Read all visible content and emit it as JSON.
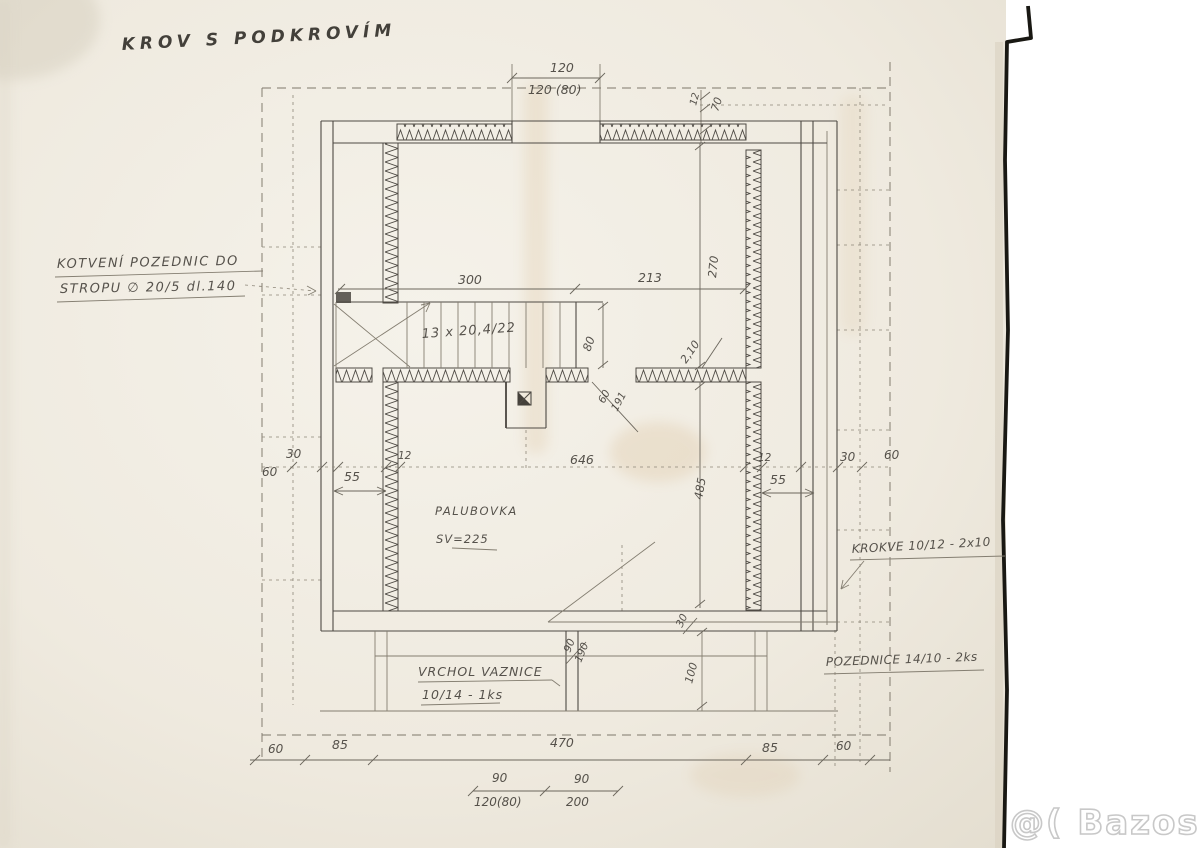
{
  "watermark": {
    "text": "@( Bazos.cz"
  },
  "colors": {
    "paper": "#f0ebe0",
    "pencil": "#4e4a44",
    "watermark_stroke": "#c8c8c8"
  },
  "labels": [
    {
      "name": "drawing-title",
      "text": "KROV S PODKROVÍM",
      "x": 122,
      "y": 50,
      "size": 17,
      "ls": 5,
      "rot": -3,
      "cls": "title"
    },
    {
      "name": "note-anchoring-line1",
      "text": "KOTVENÍ POZEDNIC DO",
      "x": 57,
      "y": 268,
      "size": 13,
      "ls": 1.5,
      "rot": -1
    },
    {
      "name": "note-anchoring-line2",
      "text": "STROPU ∅ 20/5 dl.140",
      "x": 60,
      "y": 293,
      "size": 13,
      "ls": 1.5,
      "rot": -1
    },
    {
      "name": "dim-top-120",
      "text": "120",
      "x": 550,
      "y": 72,
      "size": 12.5
    },
    {
      "name": "dim-top-120-80",
      "text": "120 (80)",
      "x": 528,
      "y": 94,
      "size": 12.5
    },
    {
      "name": "dim-top-12",
      "text": "12",
      "x": 696,
      "y": 106,
      "size": 10,
      "rot": -75
    },
    {
      "name": "dim-top-70",
      "text": "70",
      "x": 718,
      "y": 112,
      "size": 11,
      "rot": -72
    },
    {
      "name": "dim-300",
      "text": "300",
      "x": 458,
      "y": 284,
      "size": 12.5
    },
    {
      "name": "dim-213",
      "text": "213",
      "x": 638,
      "y": 282,
      "size": 12.5
    },
    {
      "name": "dim-270",
      "text": "270",
      "x": 716,
      "y": 278,
      "size": 11.5,
      "rot": -84
    },
    {
      "name": "stairs-label",
      "text": "13 x 20,4/22",
      "x": 422,
      "y": 338,
      "size": 13,
      "ls": 1,
      "rot": -4
    },
    {
      "name": "dim-80",
      "text": "80",
      "x": 590,
      "y": 352,
      "size": 11.5,
      "rot": -70
    },
    {
      "name": "dim-2-10",
      "text": "2,10",
      "x": 686,
      "y": 364,
      "size": 11,
      "rot": -55
    },
    {
      "name": "dim-60-diag",
      "text": "60",
      "x": 604,
      "y": 404,
      "size": 10.5,
      "rot": -62
    },
    {
      "name": "dim-191-diag",
      "text": "191",
      "x": 617,
      "y": 412,
      "size": 10.5,
      "rot": -62
    },
    {
      "name": "dim-left-30",
      "text": "30",
      "x": 286,
      "y": 458,
      "size": 12
    },
    {
      "name": "dim-left-60",
      "text": "60",
      "x": 262,
      "y": 476,
      "size": 12
    },
    {
      "name": "dim-left-55",
      "text": "55",
      "x": 344,
      "y": 481,
      "size": 12.5
    },
    {
      "name": "dim-left-12",
      "text": "12",
      "x": 398,
      "y": 459,
      "size": 10.5
    },
    {
      "name": "dim-646",
      "text": "646",
      "x": 570,
      "y": 464,
      "size": 12.5
    },
    {
      "name": "dim-right-12",
      "text": "12",
      "x": 758,
      "y": 461,
      "size": 10.5
    },
    {
      "name": "dim-right-55",
      "text": "55",
      "x": 770,
      "y": 484,
      "size": 12.5
    },
    {
      "name": "dim-right-30",
      "text": "30",
      "x": 840,
      "y": 461,
      "size": 12
    },
    {
      "name": "dim-right-60",
      "text": "60",
      "x": 884,
      "y": 459,
      "size": 12
    },
    {
      "name": "dim-485",
      "text": "485",
      "x": 702,
      "y": 500,
      "size": 11.5,
      "rot": -80
    },
    {
      "name": "note-palubovka",
      "text": "PALUBOVKA",
      "x": 435,
      "y": 515,
      "size": 11.5,
      "ls": 1.5
    },
    {
      "name": "note-palubovka-sv",
      "text": "SV=225",
      "x": 436,
      "y": 543,
      "size": 11.5,
      "ls": 1
    },
    {
      "name": "note-krokve",
      "text": "KROKVE 10/12 - 2x10",
      "x": 852,
      "y": 553,
      "size": 12,
      "rot": -3,
      "ls": 0.5
    },
    {
      "name": "dim-30-bottom",
      "text": "30",
      "x": 682,
      "y": 628,
      "size": 10.5,
      "rot": -65
    },
    {
      "name": "dim-90-frac",
      "text": "90",
      "x": 570,
      "y": 653,
      "size": 10.5,
      "rot": -68
    },
    {
      "name": "dim-190-frac",
      "text": "190",
      "x": 581,
      "y": 663,
      "size": 10.5,
      "rot": -68
    },
    {
      "name": "dim-100",
      "text": "100",
      "x": 692,
      "y": 684,
      "size": 11,
      "rot": -75
    },
    {
      "name": "note-vaznice-line1",
      "text": "VRCHOL VAZNICE",
      "x": 418,
      "y": 676,
      "size": 12.5,
      "ls": 1
    },
    {
      "name": "note-vaznice-line2",
      "text": "10/14 - 1ks",
      "x": 422,
      "y": 699,
      "size": 12.5,
      "ls": 1
    },
    {
      "name": "note-pozednice",
      "text": "POZEDNICE 14/10 - 2ks",
      "x": 826,
      "y": 666,
      "size": 12,
      "rot": -2,
      "ls": 0.5
    },
    {
      "name": "dim-bottom-60-left",
      "text": "60",
      "x": 268,
      "y": 753,
      "size": 12
    },
    {
      "name": "dim-bottom-85-left",
      "text": "85",
      "x": 332,
      "y": 749,
      "size": 12.5
    },
    {
      "name": "dim-bottom-470",
      "text": "470",
      "x": 550,
      "y": 747,
      "size": 12.5
    },
    {
      "name": "dim-bottom-85-right",
      "text": "85",
      "x": 762,
      "y": 752,
      "size": 12.5
    },
    {
      "name": "dim-bottom-60-right",
      "text": "60",
      "x": 836,
      "y": 750,
      "size": 12
    },
    {
      "name": "dim-sub-90-left",
      "text": "90",
      "x": 492,
      "y": 782,
      "size": 12
    },
    {
      "name": "dim-sub-120-80",
      "text": "120(80)",
      "x": 474,
      "y": 806,
      "size": 12
    },
    {
      "name": "dim-sub-90-right",
      "text": "90",
      "x": 574,
      "y": 783,
      "size": 12
    },
    {
      "name": "dim-sub-200",
      "text": "200",
      "x": 566,
      "y": 806,
      "size": 12
    }
  ]
}
